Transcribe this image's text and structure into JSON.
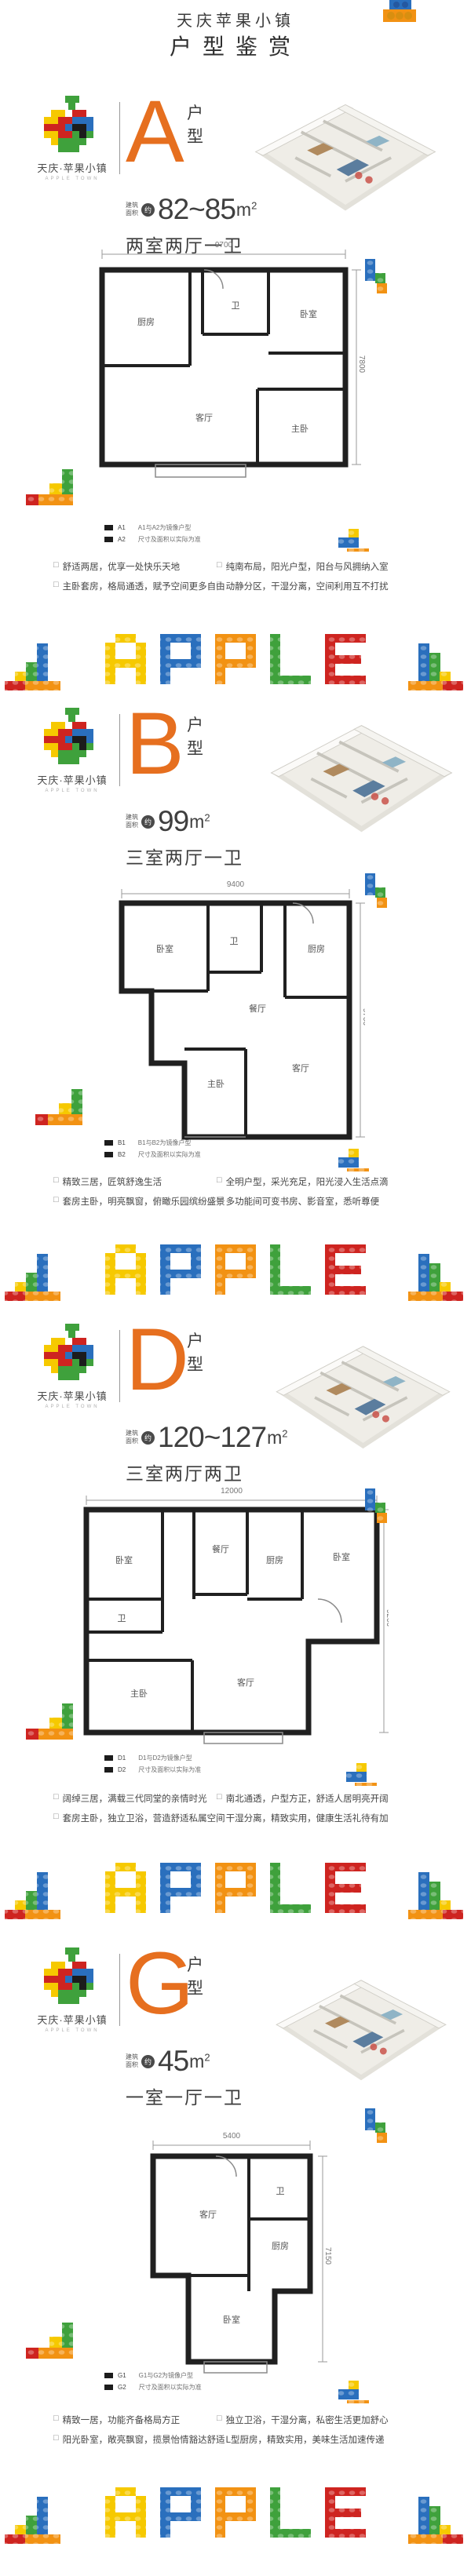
{
  "header": {
    "title": "天庆苹果小镇",
    "subtitle": "户型鉴赏"
  },
  "brand": {
    "name": "天庆·苹果小镇",
    "name_en": "APPLE TOWN"
  },
  "labels": {
    "type_label": "户型",
    "area_prefix": [
      "建筑",
      "面积"
    ],
    "approx": "约",
    "unit": "m",
    "unit_sup": "2",
    "checkbox_icon": "□"
  },
  "banner": {
    "word": "APPLE",
    "letters": [
      "A",
      "P",
      "P",
      "L",
      "E"
    ]
  },
  "colors": {
    "accent": "#E66F1F",
    "text": "#3f3f3f",
    "lego_yellow": "#F6C900",
    "lego_blue": "#2A6FBD",
    "lego_orange": "#F29213",
    "lego_green": "#3FA13C",
    "lego_red": "#CE2420"
  },
  "sections": [
    {
      "letter": "A",
      "area": "82~85",
      "rooms": "两室两厅一卫",
      "plan": {
        "top_dim": "9700",
        "right_dim": "7800",
        "room_labels": [
          "厨房",
          "卫",
          "卧室",
          "客厅",
          "主卧"
        ]
      },
      "legend": {
        "code1": "A1",
        "code2": "A2",
        "note1": "A1与A2为镜像户型",
        "note2": "尺寸及面积以实际为准"
      },
      "features": [
        "舒适两居，优享一处快乐天地",
        "主卧套房，格局通透，赋予空间更多自由",
        "纯南布局，阳光户型，阳台与风拥纳入室",
        "动静分区，干湿分离，空间利用互不打扰"
      ]
    },
    {
      "letter": "B",
      "area": "99",
      "rooms": "三室两厅一卫",
      "plan": {
        "top_dim": "9400",
        "right_dim": "9700",
        "room_labels": [
          "卧室",
          "卫",
          "厨房",
          "餐厅",
          "主卧",
          "客厅"
        ]
      },
      "legend": {
        "code1": "B1",
        "code2": "B2",
        "note1": "B1与B2为镜像户型",
        "note2": "尺寸及面积以实际为准"
      },
      "features": [
        "精致三居，匠筑舒逸生活",
        "套房主卧，明亮飘窗，俯瞰乐园缤纷盛景",
        "全明户型，采光充足，阳光浸入生活点滴",
        "多功能间可变书房、影音室，悉听尊便"
      ]
    },
    {
      "letter": "D",
      "area": "120~127",
      "rooms": "三室两厅两卫",
      "plan": {
        "top_dim": "12000",
        "right_dim": "9200",
        "room_labels": [
          "卧室",
          "餐厅",
          "厨房",
          "卧室",
          "卫",
          "主卧",
          "客厅"
        ]
      },
      "legend": {
        "code1": "D1",
        "code2": "D2",
        "note1": "D1与D2为镜像户型",
        "note2": "尺寸及面积以实际为准"
      },
      "features": [
        "阔绰三居，满载三代同堂的亲情时光",
        "套房主卧，独立卫浴，营造舒适私属空间",
        "南北通透，户型方正，舒适人居明亮开阔",
        "干湿分离，精致实用，健康生活礼待有加"
      ]
    },
    {
      "letter": "G",
      "area": "45",
      "rooms": "一室一厅一卫",
      "plan": {
        "top_dim": "5400",
        "right_dim": "7150",
        "room_labels": [
          "客厅",
          "卫",
          "厨房",
          "卧室"
        ]
      },
      "legend": {
        "code1": "G1",
        "code2": "G2",
        "note1": "G1与G2为镜像户型",
        "note2": "尺寸及面积以实际为准"
      },
      "features": [
        "精致一居，功能齐备格局方正",
        "阳光卧室，敞亮飘窗，揽景怡情豁达舒适",
        "独立卫浴，干湿分离，私密生活更加舒心",
        "L型厨房，精致实用，美味生活加速传递"
      ]
    }
  ]
}
